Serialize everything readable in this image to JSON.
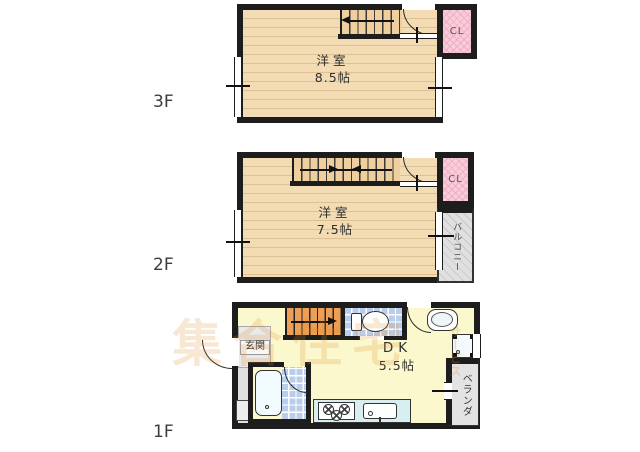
{
  "floors": [
    {
      "label": "3F",
      "room_name": "洋室",
      "room_size": "8.5帖",
      "closet_label": "CL"
    },
    {
      "label": "2F",
      "room_name": "洋室",
      "room_size": "7.5帖",
      "closet_label": "CL",
      "balcony_label": "バルコニー"
    },
    {
      "label": "1F",
      "room_name": "DK",
      "room_size": "5.5帖",
      "entrance_label": "玄関",
      "veranda_label": "ベランダ"
    }
  ],
  "watermark": {
    "text": "集合住宅",
    "suffix": "サービス"
  },
  "colors": {
    "wall": "#1d1d1d",
    "wood_floor": "#f3dcb4",
    "plank_line": "#ddc093",
    "closet_pink": "#f8ccd8",
    "floor_yellow": "#fbf8cd",
    "tile_blue": "#b9cdec",
    "counter_cyan": "#d9eef0",
    "stair_orange": "#ec9f55",
    "balcony_gray": "#e0e0e0",
    "watermark_orange": "#df8a28"
  }
}
